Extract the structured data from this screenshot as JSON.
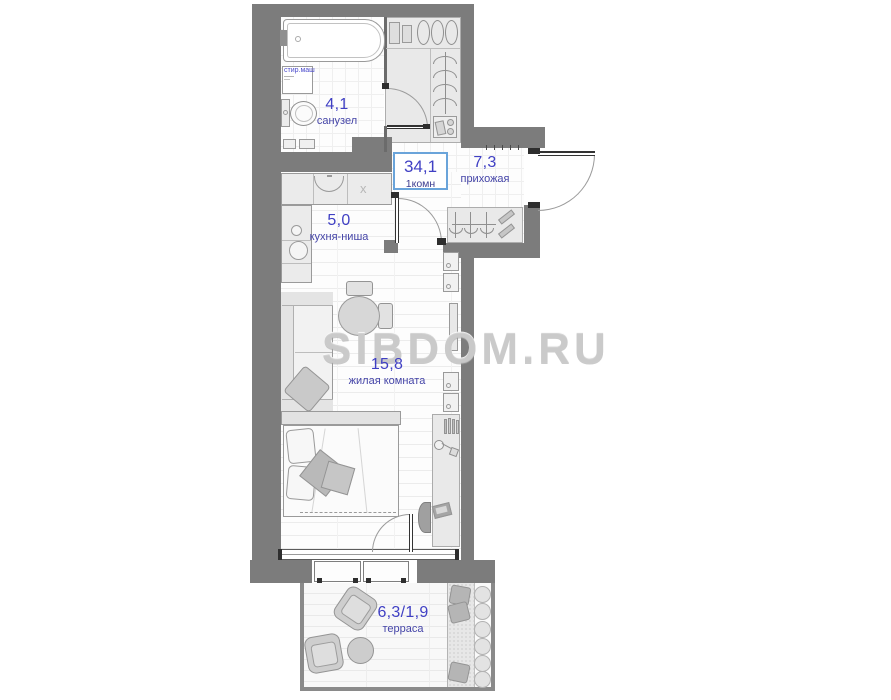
{
  "watermark": "SIBDOM.RU",
  "summary": {
    "area": "34,1",
    "type": "1комн"
  },
  "rooms": {
    "bathroom": {
      "area": "4,1",
      "name": "санузел"
    },
    "hallway": {
      "area": "7,3",
      "name": "прихожая"
    },
    "kitchen": {
      "area": "5,0",
      "name": "кухня-ниша"
    },
    "living": {
      "area": "15,8",
      "name": "жилая комната"
    },
    "terrace": {
      "area": "6,3/1,9",
      "name": "терраса"
    }
  },
  "labels": {
    "washer": "стир.маш",
    "vent": "x"
  },
  "colors": {
    "wall": "#7c7c7c",
    "label_blue": "#4040c4",
    "area_box_border": "#6aa4da",
    "watermark_gray": "#cbcbcb"
  }
}
